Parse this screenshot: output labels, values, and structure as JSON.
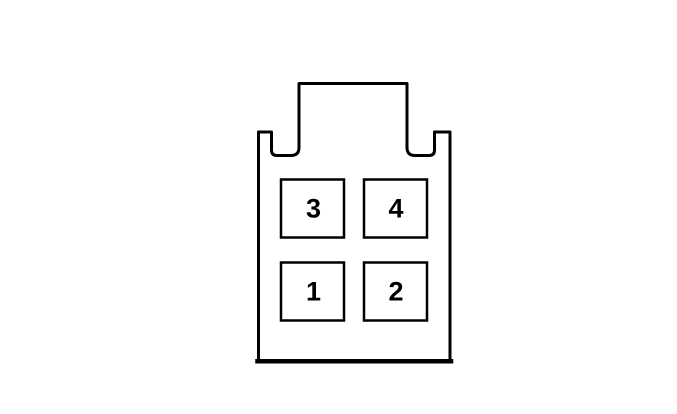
{
  "diagram": {
    "background_color": "#ffffff",
    "line_color": "#000000",
    "pins": [
      {
        "label": "3"
      },
      {
        "label": "4"
      },
      {
        "label": "1"
      },
      {
        "label": "2"
      }
    ]
  }
}
